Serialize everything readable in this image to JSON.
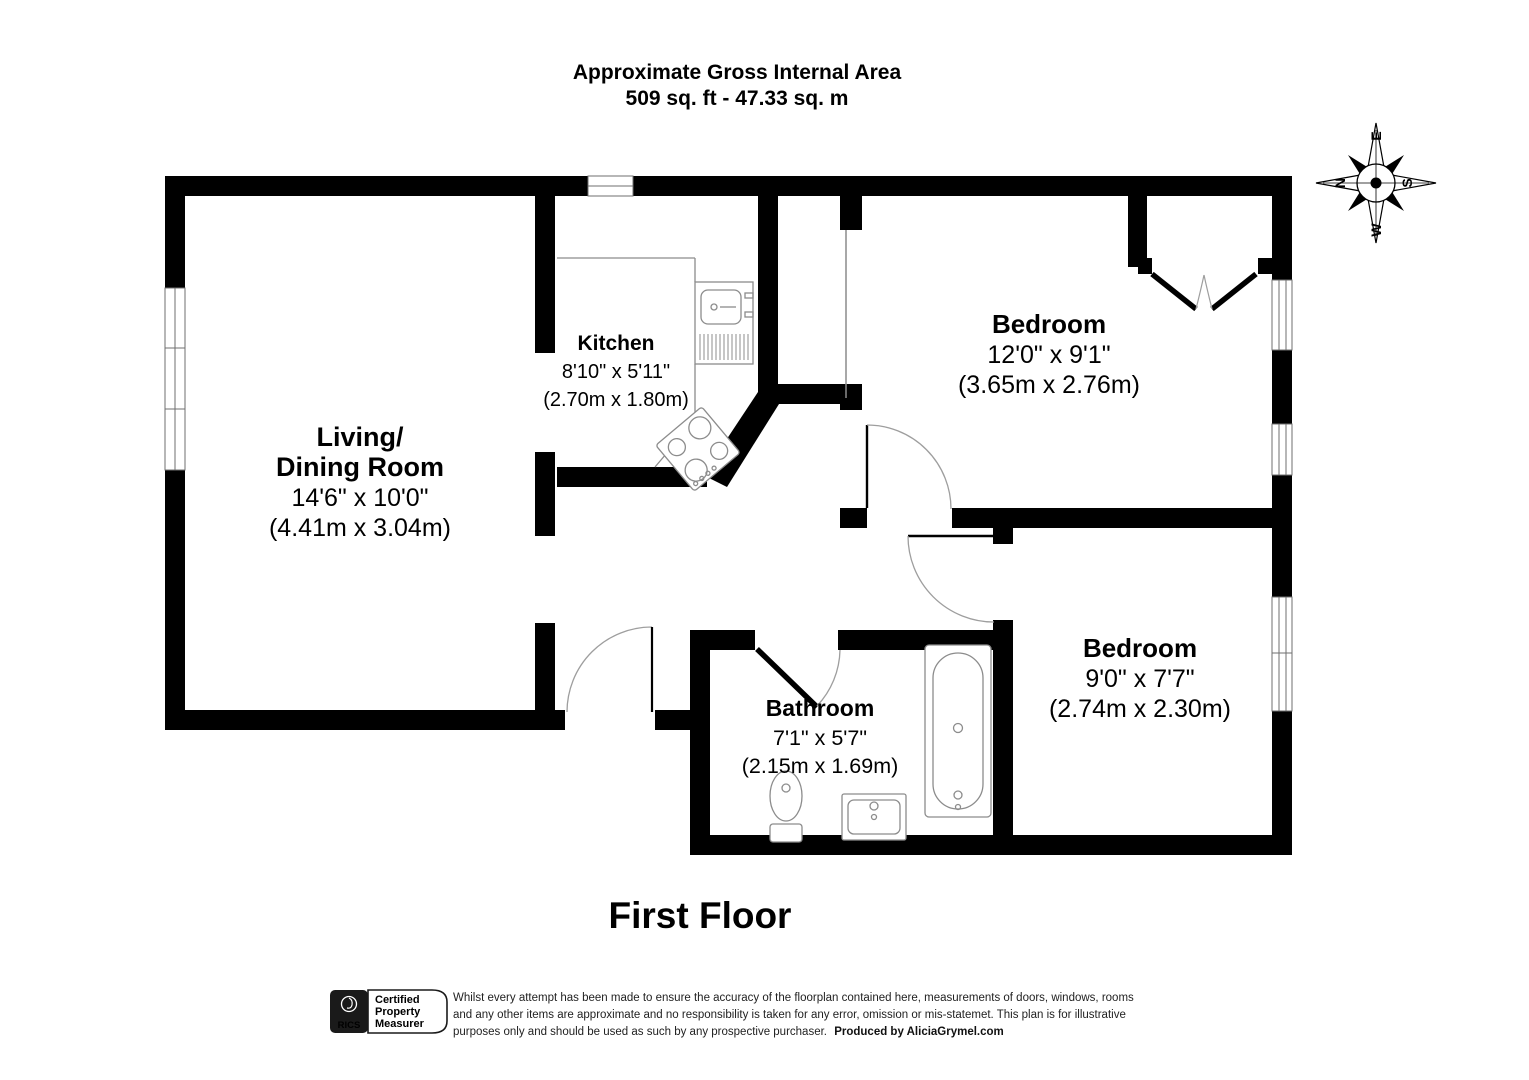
{
  "title": {
    "line1": "Approximate Gross Internal Area",
    "line2": "509 sq. ft - 47.33 sq. m"
  },
  "floor_label": "First Floor",
  "rooms": {
    "living_dining": {
      "name_line1": "Living/",
      "name_line2": "Dining Room",
      "size_imperial": "14'6\" x 10'0\"",
      "size_metric": "(4.41m x 3.04m)"
    },
    "kitchen": {
      "name": "Kitchen",
      "size_imperial": "8'10\" x 5'11\"",
      "size_metric": "(2.70m x 1.80m)"
    },
    "bedroom_1": {
      "name": "Bedroom",
      "size_imperial": "12'0\" x 9'1\"",
      "size_metric": "(3.65m x 2.76m)"
    },
    "bedroom_2": {
      "name": "Bedroom",
      "size_imperial": "9'0\" x 7'7\"",
      "size_metric": "(2.74m x 2.30m)"
    },
    "bathroom": {
      "name": "Bathroom",
      "size_imperial": "7'1\" x 5'7\"",
      "size_metric": "(2.15m x 1.69m)"
    }
  },
  "compass": {
    "north": "N",
    "east": "E",
    "south": "S",
    "west": "W"
  },
  "footer": {
    "badge": {
      "org": "RICS",
      "label_line1": "Certified",
      "label_line2": "Property",
      "label_line3": "Measurer"
    },
    "disclaimer_line1": "Whilst every attempt has been made to ensure the accuracy of the floorplan contained here, measurements of doors, windows, rooms",
    "disclaimer_line2": "and any other items are approximate and no responsibility is taken for any error, omission or mis-statemet. This plan is for illustrative",
    "disclaimer_line3": "purposes only and should be used as such by any prospective purchaser.",
    "produced_by": "Produced by AliciaGrymel.com"
  },
  "colors": {
    "wall": "#000000",
    "background": "#ffffff",
    "fixture_line": "#8c8c8c",
    "door_arc": "#9e9e9e",
    "window_line": "#6f6f6f"
  }
}
